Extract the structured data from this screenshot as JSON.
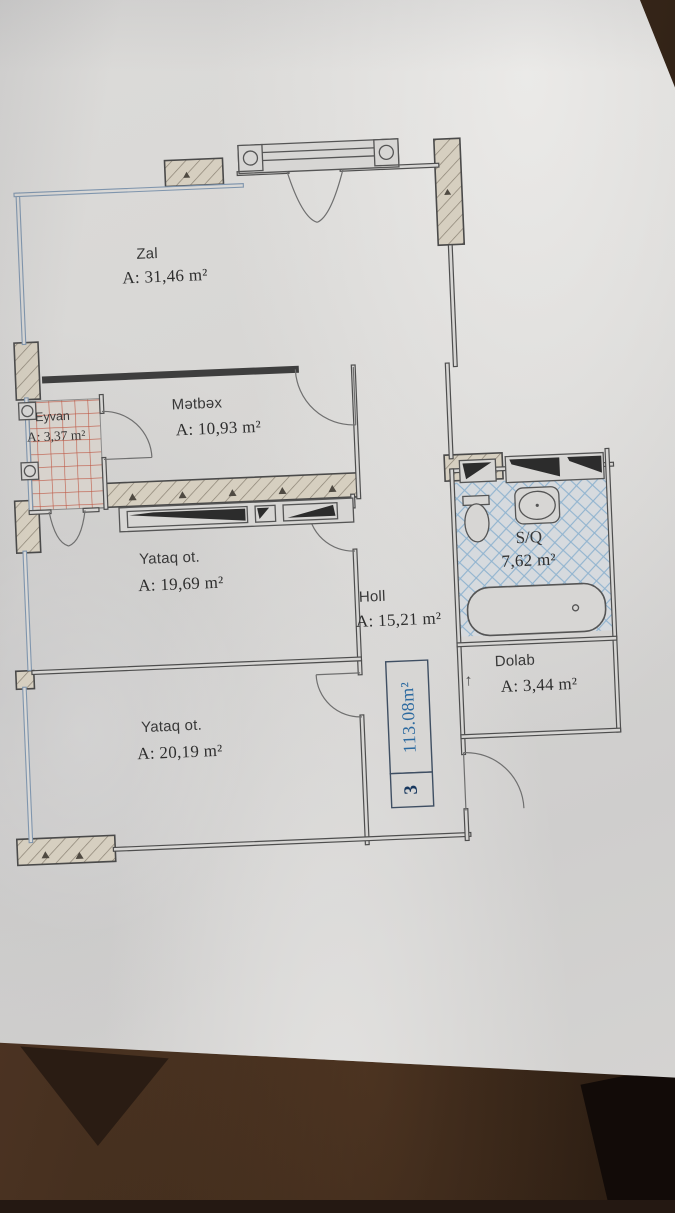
{
  "photo": {
    "subject": "apartment floor plan drawing on a paper sheet lying on a wooden table"
  },
  "plan": {
    "unit_number": "3",
    "total_area": "113.08m²",
    "dolab_arrow": "↑",
    "rooms": [
      {
        "id": "zal",
        "name": "Zal",
        "area": "A: 31,46 m²"
      },
      {
        "id": "eyvan",
        "name": "Eyvan",
        "area": "A: 3,37 m²"
      },
      {
        "id": "metbex",
        "name": "Mətbəx",
        "area": "A: 10,93 m²"
      },
      {
        "id": "yataq1",
        "name": "Yataq ot.",
        "area": "A: 19,69 m²"
      },
      {
        "id": "holl",
        "name": "Holl",
        "area": "A: 15,21 m²"
      },
      {
        "id": "sq",
        "name": "S/Q",
        "area": "7,62 m²"
      },
      {
        "id": "dolab",
        "name": "Dolab",
        "area": "A: 3,44 m²"
      },
      {
        "id": "yataq2",
        "name": "Yataq ot.",
        "area": "A: 20,19 m²"
      }
    ],
    "colors": {
      "paper": "#d7d6d4",
      "ink": "#4e4e4e",
      "window_wall": "#7f95ad",
      "balcony_hatch": "#bf5a47",
      "wet_room_hatch": "#8fb3cf",
      "accent_blue": "#2c6aa0",
      "table_wood": "#46301f"
    }
  }
}
